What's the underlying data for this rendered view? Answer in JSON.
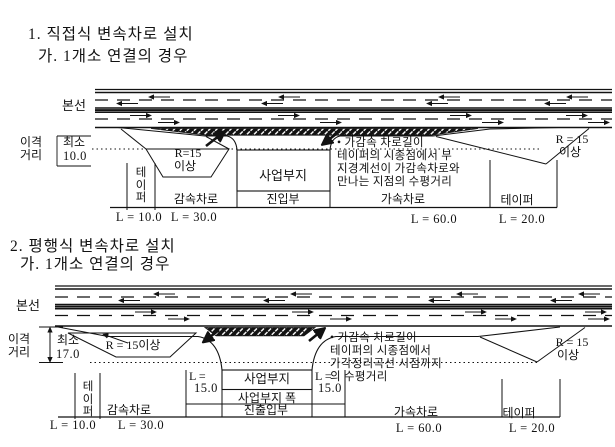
{
  "section1": {
    "title": "1. 직접식 변속차로 설치",
    "subtitle": "가. 1개소 연결의 경우",
    "diagram": {
      "mainline_label": "본선",
      "offset_label_line1": "이격",
      "offset_label_line2": "거리",
      "offset_min": "최소",
      "offset_value": "10.0",
      "radius_left_line1": "R=15",
      "radius_left_line2": "이상",
      "radius_right_line1": "R = 15",
      "radius_right_line2": "이상",
      "site_label": "사업부지",
      "note_line1": "• 가감속 차로길이",
      "note_line2": "테이퍼의 시종점에서 부",
      "note_line3": "지경계선이 가감속차로와",
      "note_line4": "만나는 지점의 수평거리",
      "seg_taper_left": "테이퍼",
      "seg_decel": "감속차로",
      "seg_entry": "진입부",
      "seg_accel": "가속차로",
      "seg_taper_right": "테이퍼",
      "dim_taper_left": "L = 10.0",
      "dim_decel": "L = 30.0",
      "dim_accel": "L = 60.0",
      "dim_taper_right": "L = 20.0"
    }
  },
  "section2": {
    "title": "2. 평행식 변속차로 설치",
    "subtitle": "가. 1개소 연결의 경우",
    "diagram": {
      "mainline_label": "본선",
      "offset_label_line1": "이격",
      "offset_label_line2": "거리",
      "offset_min": "최소",
      "offset_value": "17.0",
      "radius_left": "R = 15이상",
      "radius_right_line1": "R = 15",
      "radius_right_line2": "이상",
      "site_label": "사업부지",
      "site_width_label": "사업부지 폭",
      "entry_exit_label": "진출입부",
      "dim_side_left_line1": "L =",
      "dim_side_left_line2": "15.0",
      "dim_side_right_line1": "L =",
      "dim_side_right_line2": "15.0",
      "note_line1": "• 가감속 차로길이",
      "note_line2": "테이퍼의 시종점에서",
      "note_line3": "가각정리곡선 시점까지",
      "note_line4": "의 수평거리",
      "seg_taper_left": "테이퍼",
      "seg_decel": "감속차로",
      "seg_accel": "가속차로",
      "seg_taper_right": "테이퍼",
      "dim_taper_left": "L = 10.0",
      "dim_decel": "L = 30.0",
      "dim_accel": "L = 60.0",
      "dim_taper_right": "L = 20.0"
    }
  }
}
